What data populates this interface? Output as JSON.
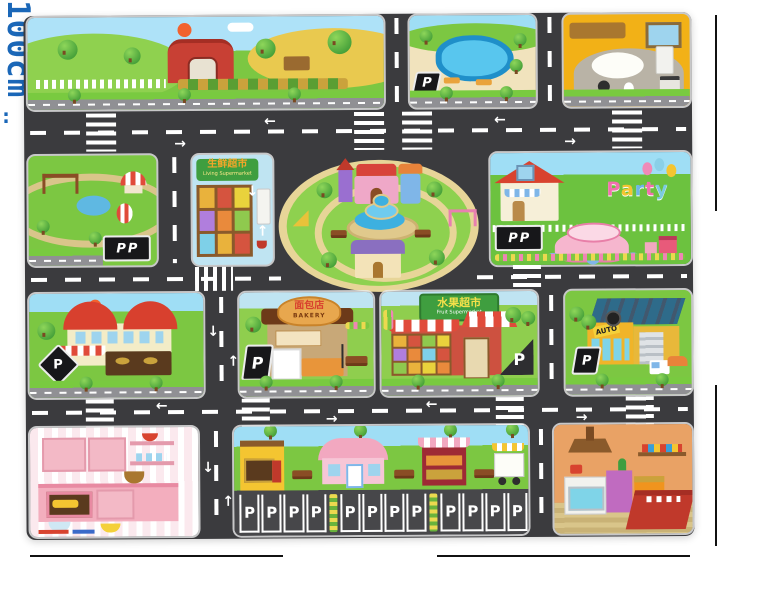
{
  "annotations": {
    "width_label": "130cm",
    "width_separator": ":",
    "height_label": "100cm",
    "label_color": "#1a67b8"
  },
  "mat": {
    "road_color": "#3b3b3e",
    "grass_color": "#7cc742",
    "signs": {
      "parking": "P",
      "bakery_cn": "面包店",
      "bakery_en": "BAKERY",
      "fruit_market_cn": "水果超市",
      "fruit_market_en": "Fruit Supermarket",
      "fresh_market_cn": "生鲜超市",
      "fresh_market_en": "Living Supermarket",
      "auto_shop": "AUTO",
      "party_letters": [
        "P",
        "a",
        "r",
        "t",
        "y"
      ],
      "party_colors": [
        "#f26fae",
        "#f4c531",
        "#6db5e8",
        "#f26fae",
        "#7ccbe0"
      ]
    },
    "parking_lot": {
      "stall_label": "P",
      "groups": 3,
      "stalls_per_group": 4
    }
  }
}
